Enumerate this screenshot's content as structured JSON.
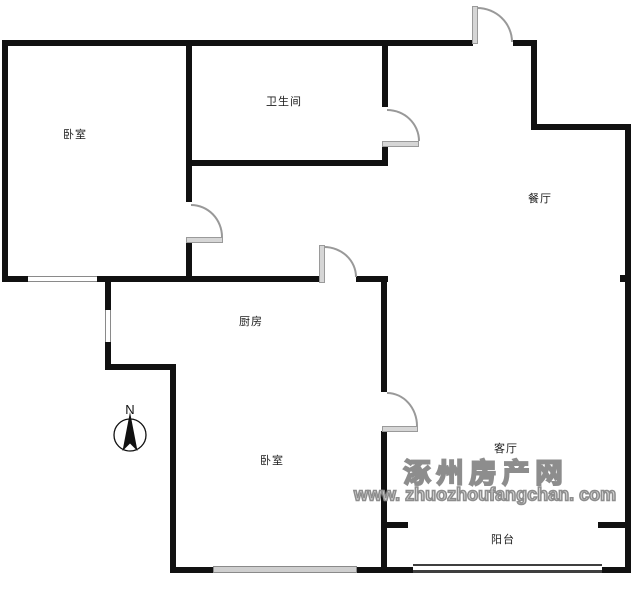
{
  "rooms": [
    {
      "id": "bedroom-1",
      "label": "卧室"
    },
    {
      "id": "bathroom",
      "label": "卫生间"
    },
    {
      "id": "dining-room",
      "label": "餐厅"
    },
    {
      "id": "kitchen",
      "label": "厨房"
    },
    {
      "id": "bedroom-2",
      "label": "卧室"
    },
    {
      "id": "living-room",
      "label": "客厅"
    },
    {
      "id": "balcony",
      "label": "阳台"
    }
  ],
  "compass": {
    "label": "N"
  },
  "watermark": {
    "site_name": "涿州房产网",
    "site_url": "www. zhuozhoufangchan. com"
  },
  "colors": {
    "wall": "#111111",
    "door_leaf": "#d6d6d6",
    "door_arc": "#999999",
    "window_frame": "#8a8a8a",
    "watermark": "#8d8d8d"
  }
}
